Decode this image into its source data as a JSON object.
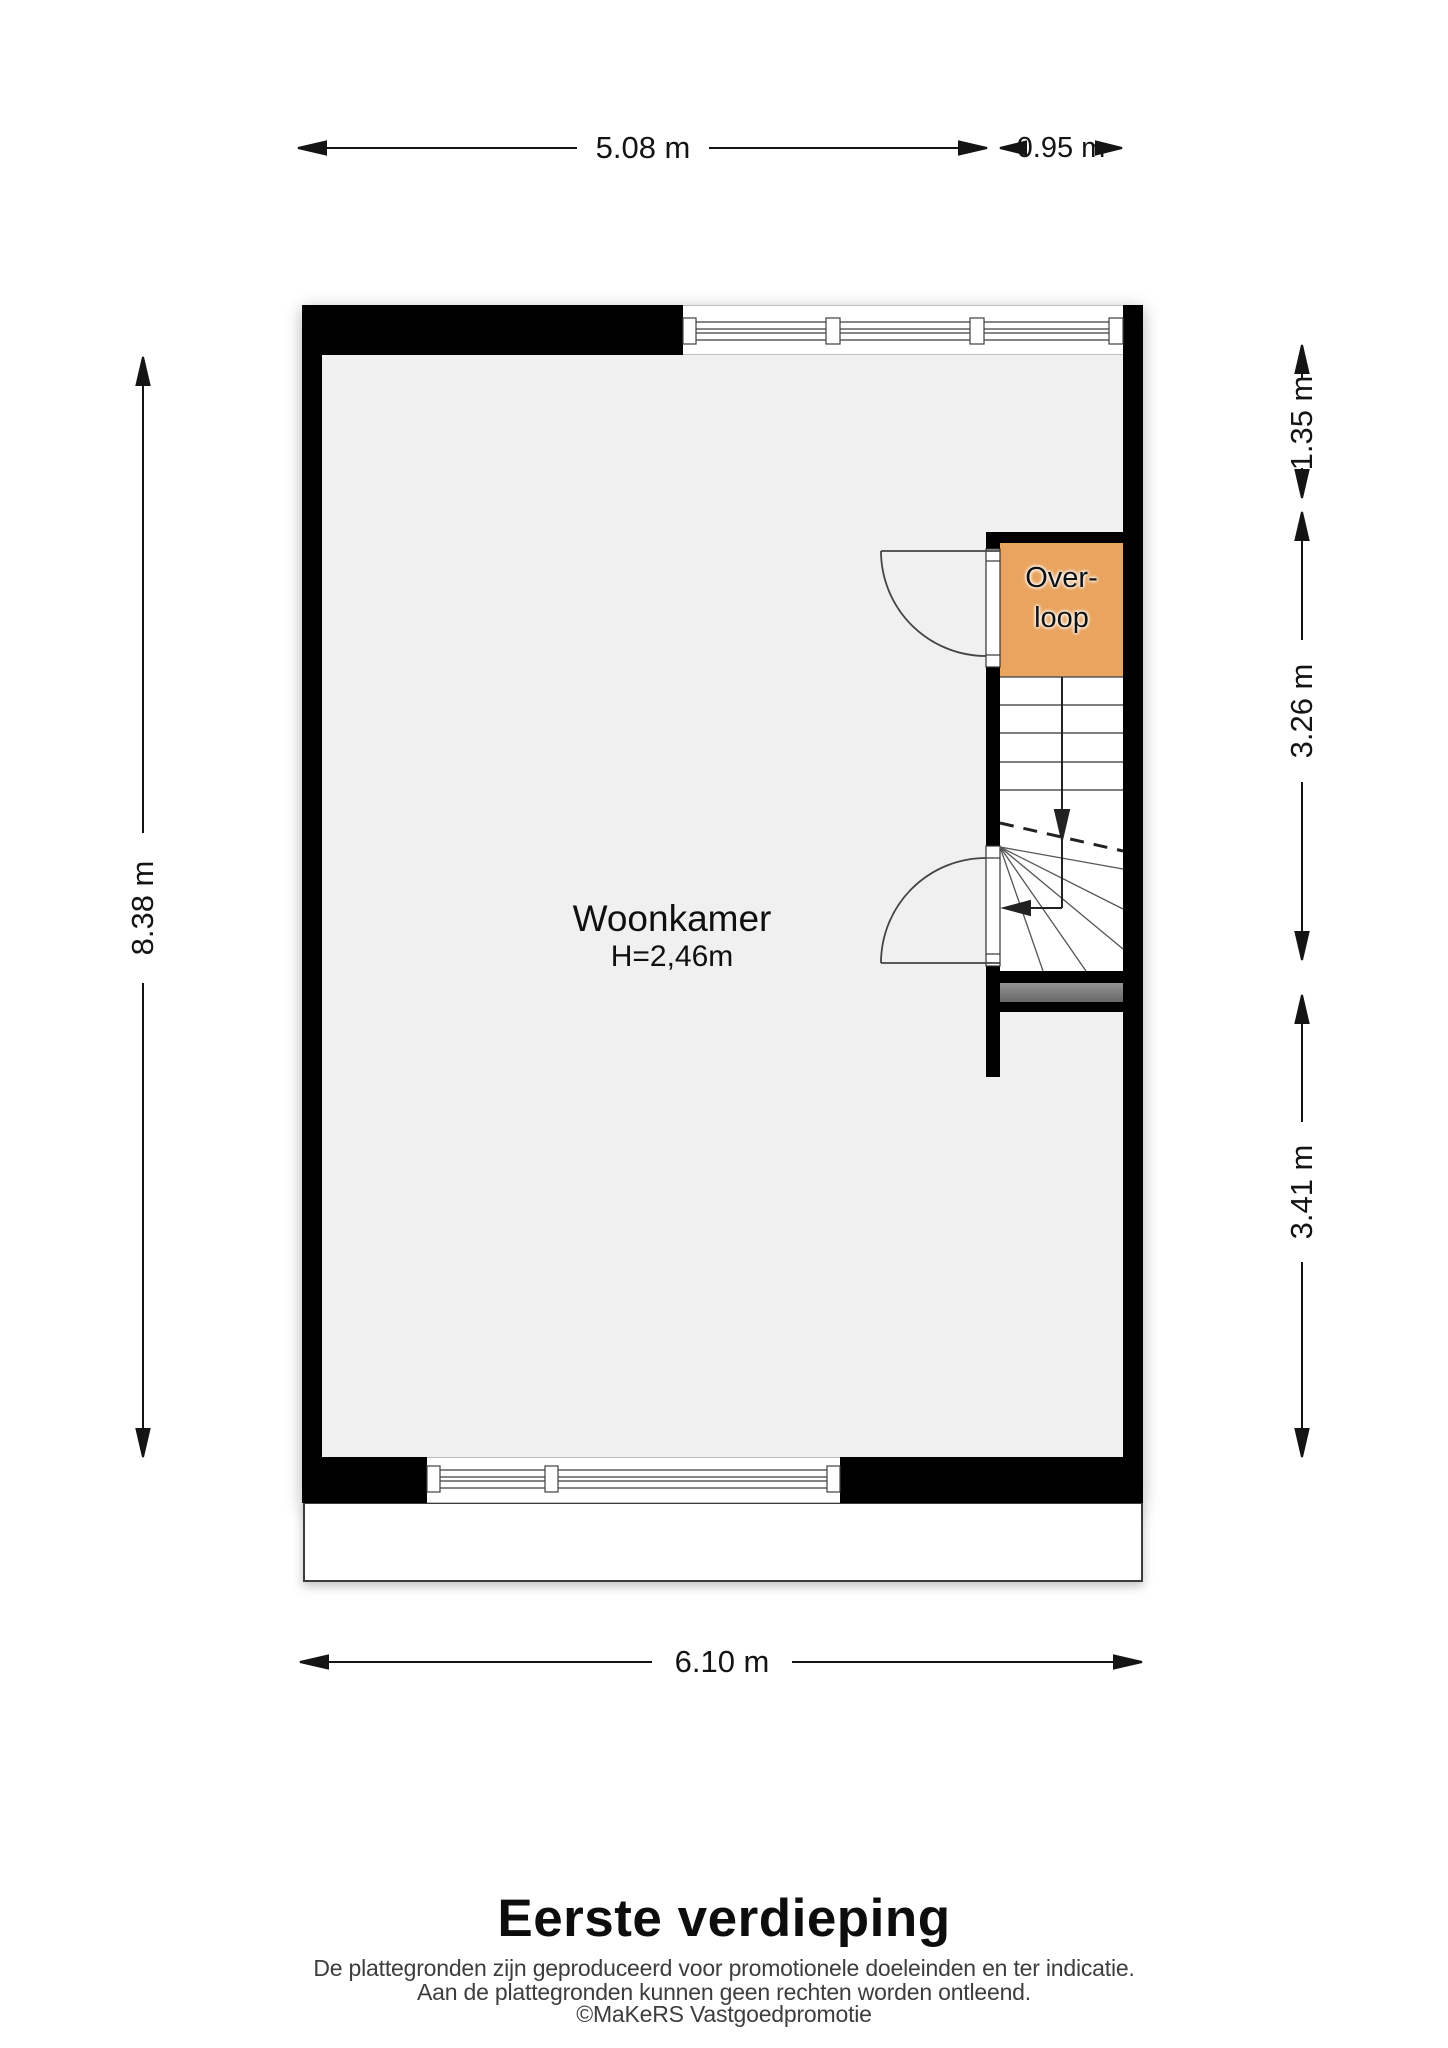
{
  "fp": {
    "title": "Eerste verdieping",
    "disclaimer": {
      "l1": "De plattegronden zijn geproduceerd voor promotionele doeleinden en ter indicatie.",
      "l2": "Aan de plattegronden kunnen geen rechten worden ontleend.",
      "credit": "©MaKeRS Vastgoedpromotie"
    },
    "rooms": {
      "living": {
        "name": "Woonkamer",
        "height": "H=2,46m"
      },
      "landing": {
        "l1": "Over-",
        "l2": "loop"
      }
    },
    "dims": {
      "top_main": "5.08 m",
      "top_stair": "0.95 m",
      "left_total": "8.38 m",
      "right_top": "1.35 m",
      "right_mid": "3.26 m",
      "right_bottom": "3.41 m",
      "bottom_total": "6.10 m"
    },
    "colors": {
      "wall": "#000000",
      "floor": "#f0f0f0",
      "landing_fill": "#e9a45f",
      "stair_base": "#7d7d7d",
      "line": "#3f3f3f",
      "text": "#141414"
    }
  }
}
